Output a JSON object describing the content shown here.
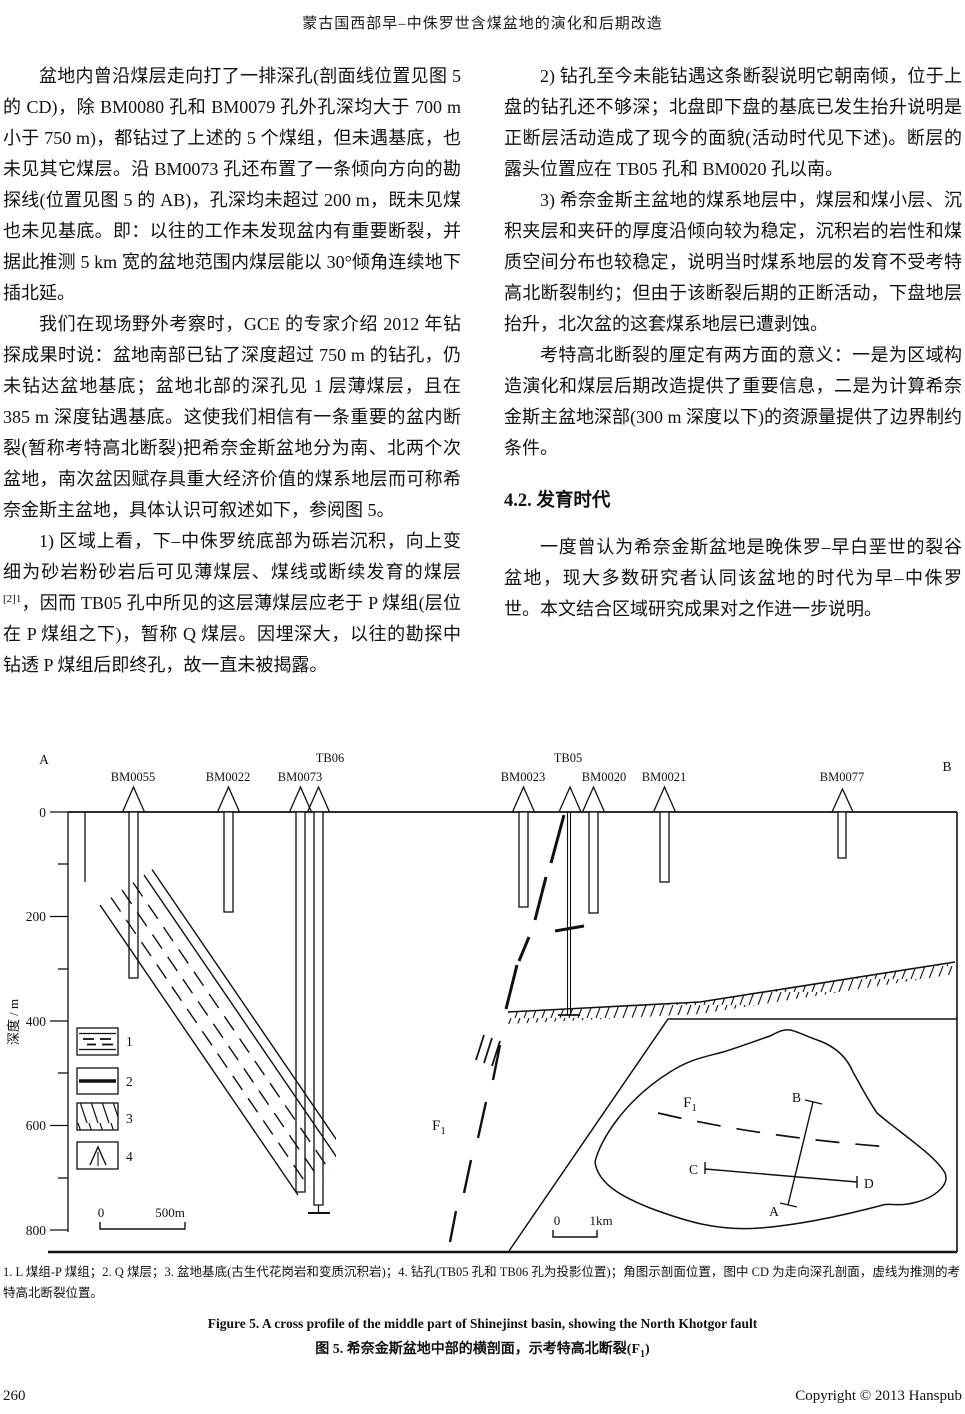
{
  "header": {
    "title": "蒙古国西部早–中侏罗世含煤盆地的演化和后期改造"
  },
  "left_column": {
    "p1": "盆地内曾沿煤层走向打了一排深孔(剖面线位置见图 5 的 CD)，除 BM0080 孔和 BM0079 孔外孔深均大于 700 m 小于 750 m)，都钻过了上述的 5 个煤组，但未遇基底，也未见其它煤层。沿 BM0073 孔还布置了一条倾向方向的勘探线(位置见图 5 的 AB)，孔深均未超过 200 m，既未见煤也未见基底。即：以往的工作未发现盆内有重要断裂，并据此推测 5 km 宽的盆地范围内煤层能以 30°倾角连续地下插北延。",
    "p2": "我们在现场野外考察时，GCE 的专家介绍 2012 年钻探成果时说：盆地南部已钻了深度超过 750 m 的钻孔，仍未钻达盆地基底；盆地北部的深孔见 1 层薄煤层，且在 385 m 深度钻遇基底。这使我们相信有一条重要的盆内断裂(暂称考特高北断裂)把希奈金斯盆地分为南、北两个次盆地，南次盆因赋存具重大经济价值的煤系地层而可称希奈金斯主盆地，具体认识可叙述如下，参阅图 5。",
    "p3_pre": "1) 区域上看，下–中侏罗统底部为砾岩沉积，向上变细为砂岩粉砂岩后可见薄煤层、煤线或断续发育的煤层",
    "p3_sup": "[2]1",
    "p3_post": "，因而 TB05 孔中所见的这层薄煤层应老于 P 煤组(层位在 P 煤组之下)，暂称 Q 煤层。因埋深大，以往的勘探中钻透 P 煤组后即终孔，故一直未被揭露。"
  },
  "right_column": {
    "p1": "2) 钻孔至今未能钻遇这条断裂说明它朝南倾，位于上盘的钻孔还不够深；北盘即下盘的基底已发生抬升说明是正断层活动造成了现今的面貌(活动时代见下述)。断层的露头位置应在 TB05 孔和 BM0020 孔以南。",
    "p2": "3) 希奈金斯主盆地的煤系地层中，煤层和煤小层、沉积夹层和夹矸的厚度沿倾向较为稳定，沉积岩的岩性和煤质空间分布也较稳定，说明当时煤系地层的发育不受考特高北断裂制约；但由于该断裂后期的正断活动，下盘地层抬升，北次盆的这套煤系地层已遭剥蚀。",
    "p3": "考特高北断裂的厘定有两方面的意义：一是为区域构造演化和煤层后期改造提供了重要信息，二是为计算希奈金斯主盆地深部(300 m 深度以下)的资源量提供了边界制约条件。",
    "section_heading": "4.2. 发育时代",
    "p4": "一度曾认为希奈金斯盆地是晚侏罗–早白垩世的裂谷盆地，现大多数研究者认同该盆地的时代为早–中侏罗世。本文结合区域研究成果对之作进一步说明。"
  },
  "figure": {
    "endpoint_a": "A",
    "endpoint_b": "B",
    "tb06": "TB06",
    "tb05": "TB05",
    "well_labels": [
      "BM0055",
      "BM0022",
      "BM0073",
      "BM0023",
      "BM0020",
      "BM0021",
      "BM0077"
    ],
    "depth_axis_label": "深度 / m",
    "depth_ticks": [
      "0",
      "200",
      "400",
      "600",
      "800"
    ],
    "legend_nums": [
      "1",
      "2",
      "3",
      "4"
    ],
    "scale_section": {
      "zero": "0",
      "label": "500m"
    },
    "scale_inset": {
      "zero": "0",
      "label": "1km"
    },
    "fault_f": "F",
    "fault_sub": "1",
    "inset": {
      "a": "A",
      "b": "B",
      "c": "C",
      "d": "D"
    }
  },
  "caption": {
    "note": "1. L 煤组-P 煤组；2. Q 煤层；3. 盆地基底(古生代花岗岩和变质沉积岩)；4. 钻孔(TB05 孔和 TB06 孔为投影位置)；角图示剖面位置，图中 CD 为走向深孔剖面，虚线为推测的考特高北断裂位置。",
    "en": "Figure 5. A cross profile of the middle part of Shinejinst basin, showing the North Khotgor fault",
    "zh_pre": "图 5. 希奈金斯盆地中部的横剖面，示考特高北断裂(F",
    "zh_sub": "1",
    "zh_post": ")"
  },
  "footer": {
    "page_number": "260",
    "copyright": "Copyright © 2013 Hanspub"
  }
}
